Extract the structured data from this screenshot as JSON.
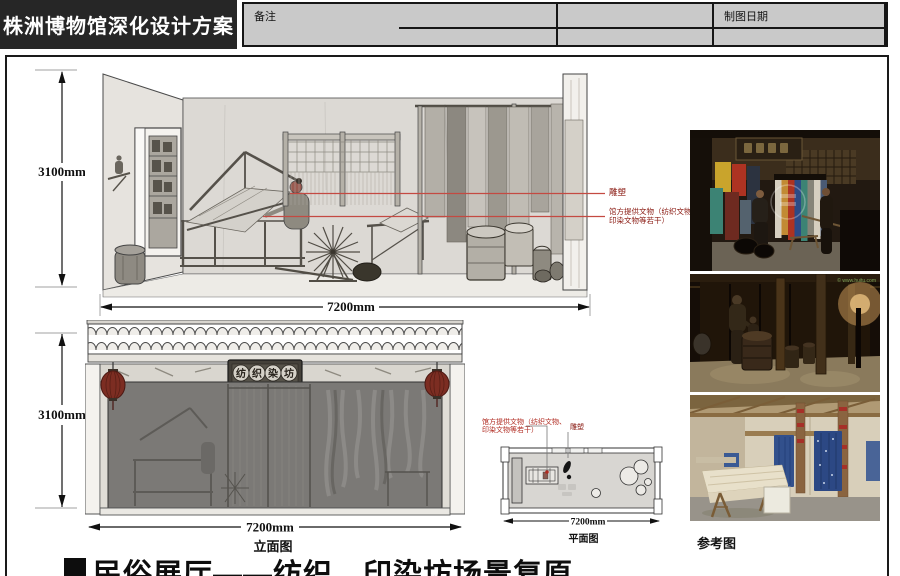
{
  "header": {
    "title": "株洲博物馆深化设计方案",
    "drawing_date_label": "制图日期",
    "notes_label": "备注"
  },
  "elevation1": {
    "height_dim": "3100mm",
    "width_dim": "7200mm",
    "ann_sculpture": "雕塑",
    "ann_relics_line1": "馆方提供文物（纺织文物、",
    "ann_relics_line2": "印染文物等若干）"
  },
  "elevation2": {
    "height_dim": "3100mm",
    "width_dim": "7200mm",
    "caption": "立面图",
    "sign_chars": [
      "纺",
      "织",
      "染",
      "坊"
    ]
  },
  "plan": {
    "width_dim": "7200mm",
    "caption": "平面图",
    "ann_relics_line1": "馆方提供文物（纺织文物、",
    "ann_relics_line2": "印染文物等若干）",
    "ann_sculpture": "雕塑"
  },
  "reference": {
    "label": "参考图",
    "watermark": "© www.huitu.com"
  },
  "footer": {
    "caption": "民俗展厅——纺织、印染坊场景复原"
  },
  "colors": {
    "annotation_red": "#b02a20",
    "leader_red": "#c44a42",
    "header_bg": "#c9c9c9",
    "title_bg": "#262626"
  }
}
